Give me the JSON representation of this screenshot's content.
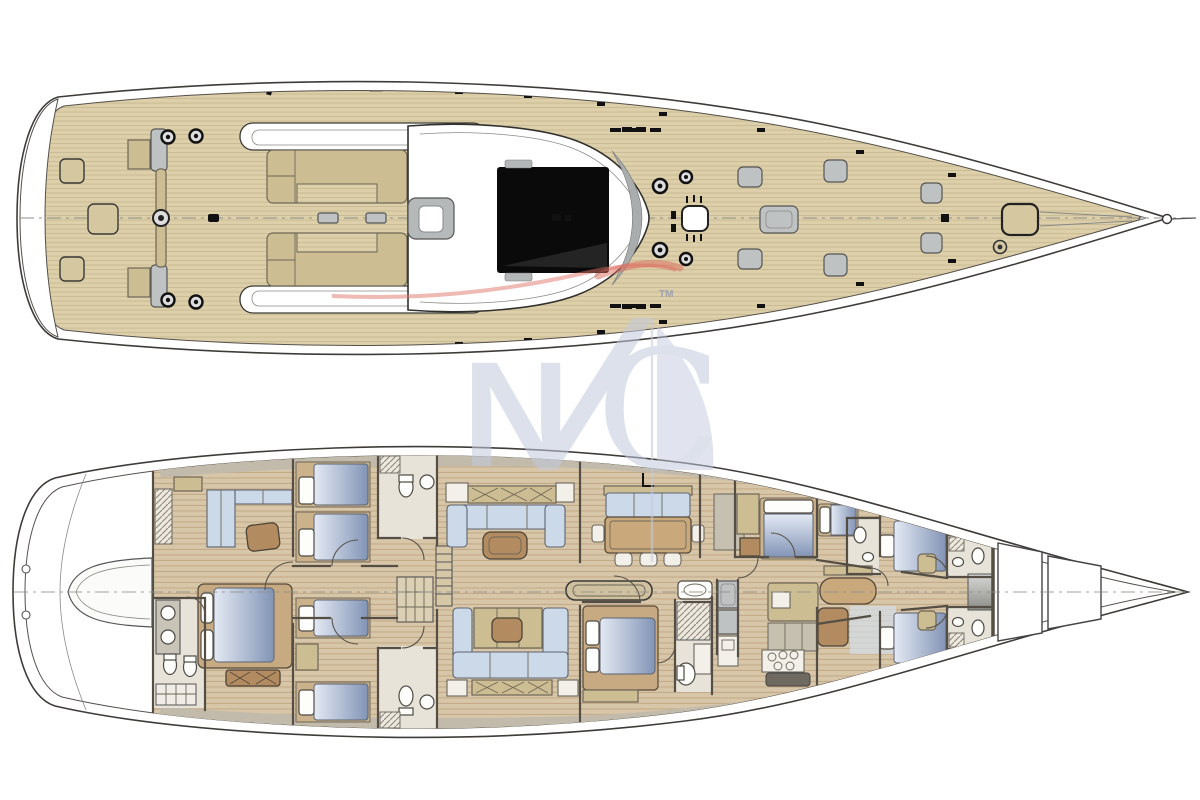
{
  "watermark": {
    "letter_left": "N",
    "letter_right": "C",
    "trademark": "TM"
  },
  "colors": {
    "line": "#3f3c38",
    "wall": "#544e45",
    "deck_teak": "#dccfaa",
    "deck_stripe": "#c9bb93",
    "floor_teak": "#d8c6a8",
    "floor_stripe": "#c3ab89",
    "tan": "#cdbd93",
    "wood": "#b28b60",
    "table": "#c9a97c",
    "blue_sofa": "#ccd9e9",
    "bed_light": "#e4eaf4",
    "bed_dark": "#8294b6",
    "fixture": "#bfc2c3",
    "cab": "#c6c0b1",
    "glass_black": "#0a0a0a",
    "bath": "#e7e3d9",
    "wm": "#c3cade",
    "wmred": "#dc6a5b"
  }
}
